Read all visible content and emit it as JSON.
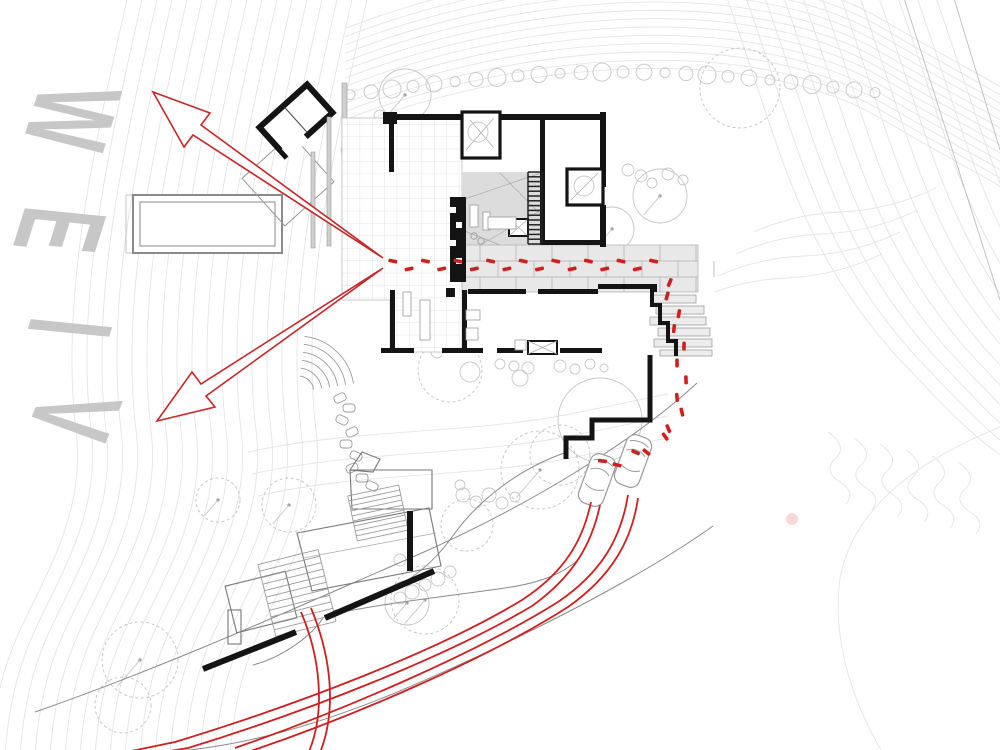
{
  "annotations": {
    "view_word": "VIEW",
    "view_letters": [
      "V",
      "I",
      "E",
      "W"
    ]
  },
  "colors": {
    "route_red": "#d01f1f",
    "wall_black": "#141414",
    "contour_gray": "#e4e4e4",
    "view_text_gray": "#c7c7c7",
    "floor_gray": "#dcdcdc",
    "paver_gray": "#e8e8e8"
  }
}
